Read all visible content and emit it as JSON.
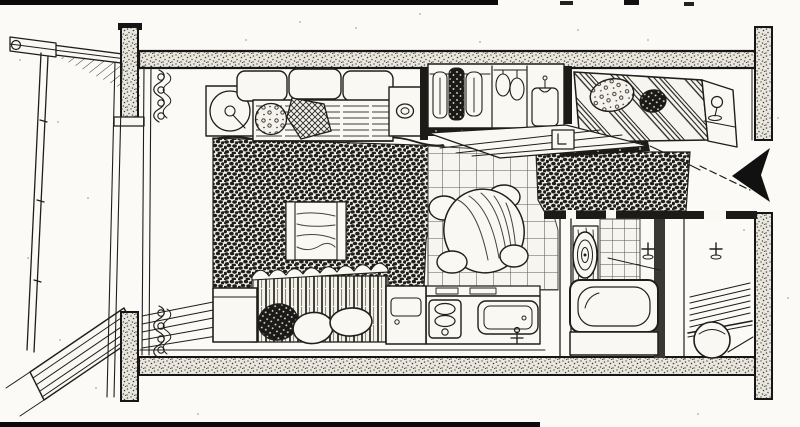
{
  "image": {
    "title": "Hand-drawn cutaway axonometric drawing of a compact studio apartment",
    "type": "pen-and-ink architectural illustration",
    "visible_text": "none",
    "palette": {
      "paper": "#f9f8f3",
      "ink": "#1f1e1a",
      "concrete_stipple_fill": "#eae7df",
      "arrow_fill": "#111111"
    }
  },
  "glyphs": {
    "entrance_arrow": "solid black left-pointing arrow in the doorway gap of the right wall"
  },
  "scene": {
    "balcony": {
      "label": "balcony",
      "elements": [
        "eave beams",
        "corner bracket",
        "drainpipe railing",
        "wood deck planks"
      ]
    },
    "living_area": {
      "label": "living area",
      "elements": [
        "round swivel armchair",
        "three-cushion sofa",
        "striped seat blanket",
        "knit throw pillows",
        "side table with cup",
        "shag carpet",
        "low wooden table",
        "curtain bunches with rings",
        "window floor planks"
      ]
    },
    "bed_front": {
      "label": "bed (foreground)",
      "elements": [
        "vertical striped bedcover",
        "two white pillows",
        "dark knit cushion",
        "white nightstand cube"
      ]
    },
    "closet": {
      "label": "closet",
      "elements": [
        "hanging garments",
        "dark textured coat",
        "wire hangers",
        "shirt on hanger",
        "dark sliding track",
        "plank step",
        "small clock box"
      ]
    },
    "bed_back": {
      "label": "bed (rear, by entrance)",
      "elements": [
        "diagonal striped duvet",
        "patterned pillow",
        "dark speckled pillow",
        "headboard shelf with lamp",
        "dark bed rail",
        "rug strip"
      ]
    },
    "kitchen": {
      "label": "kitchen",
      "elements": [
        "tiled floor",
        "round wood-grain dining table",
        "four white stools",
        "counter",
        "washing machine with lid",
        "two-burner stove panel",
        "sink with faucet"
      ]
    },
    "bathroom": {
      "label": "bathroom",
      "elements": [
        "wood-grain panel",
        "oval mirror",
        "tiled wall",
        "wall tap",
        "bathtub with inner basin"
      ]
    },
    "entry": {
      "label": "entry / utility room",
      "elements": [
        "wall tap",
        "slatted shoe shelf",
        "round basket"
      ]
    },
    "structure": {
      "label": "building structure",
      "elements": [
        "stippled top slab",
        "stippled bottom slab",
        "left cut columns",
        "right cut column with entrance gap"
      ]
    },
    "artifacts": {
      "label": "scan borders",
      "elements": [
        "black line top edge",
        "black line bottom edge"
      ]
    }
  }
}
